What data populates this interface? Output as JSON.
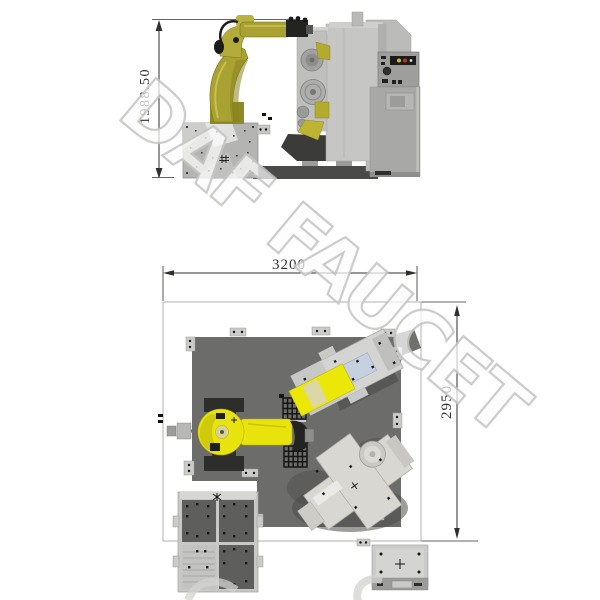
{
  "watermark": {
    "text": "DAF FAUCET"
  },
  "dimensions": {
    "robot_height": "1988.50",
    "cell_width": "3200",
    "cell_depth": "2950"
  },
  "colors": {
    "robot_yellow_plan": "#e8e30d",
    "robot_olive": "#a9a232",
    "machine_gray": "#c6c6c4",
    "cabinet_gray": "#a8a8a6",
    "floor_gray": "#6c6c6a",
    "dark_metal": "#3b3b39",
    "accent_blue": "#c5d1e0",
    "dimension_ink": "#2f2f2d",
    "watermark_stroke": "#c6c6c4",
    "boundary_line": "#b2b2b0"
  }
}
